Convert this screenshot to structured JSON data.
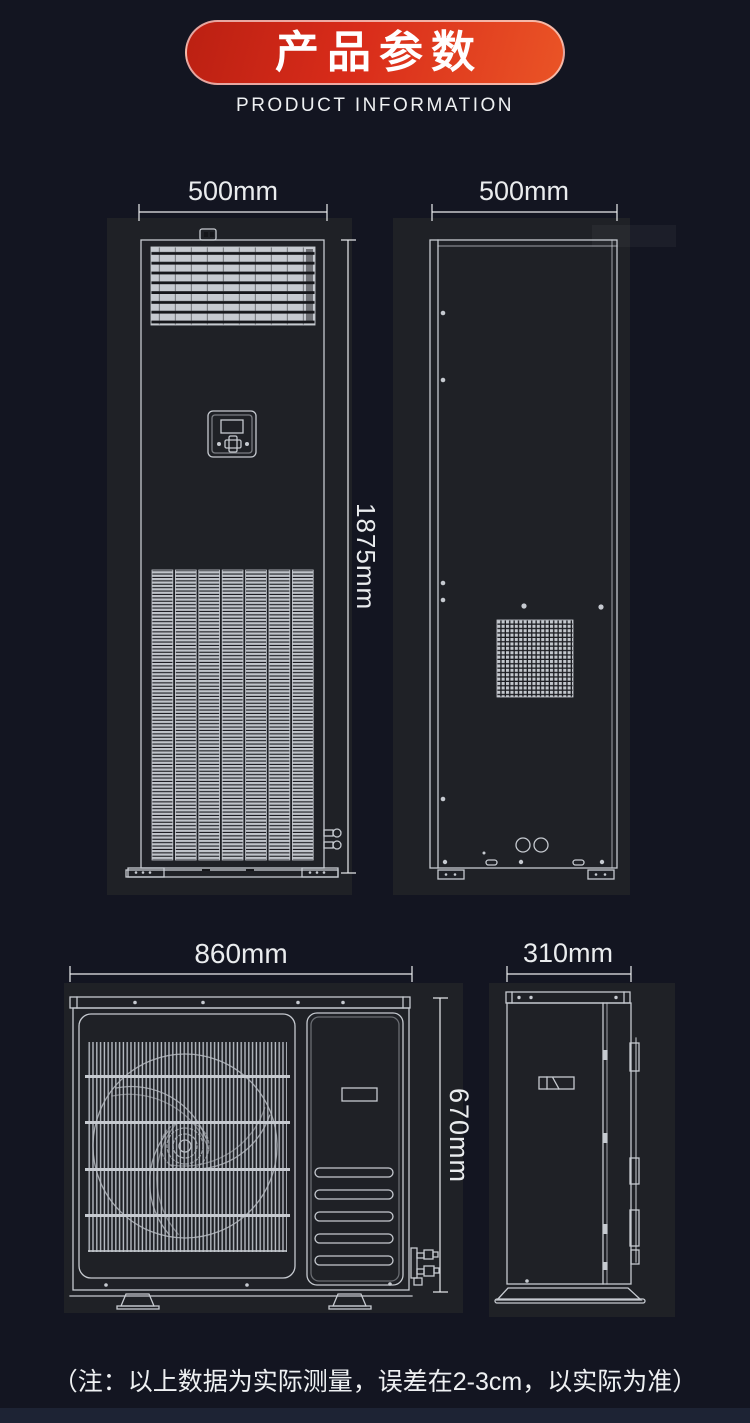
{
  "header": {
    "title": "产品参数",
    "subtitle": "PRODUCT INFORMATION"
  },
  "dimensions": {
    "indoor_front_width": "500mm",
    "indoor_side_depth": "500mm",
    "indoor_height": "1875mm",
    "outdoor_front_width": "860mm",
    "outdoor_height": "670mm",
    "outdoor_side_depth": "310mm"
  },
  "note": "（注：以上数据为实际测量，误差在2-3cm，以实际为准）",
  "colors": {
    "background": "#131521",
    "panel": "#1f2126",
    "line": "#c6cad0",
    "dim_text": "#eaecee",
    "banner_red_dark": "#bb2012",
    "banner_red_mid": "#d92c1a",
    "banner_red_bright": "#ea5426",
    "banner_border": "#ffffff99",
    "title_text": "#ffffff",
    "subtitle_text": "#eef0f2",
    "note_text": "#eef0f2"
  }
}
